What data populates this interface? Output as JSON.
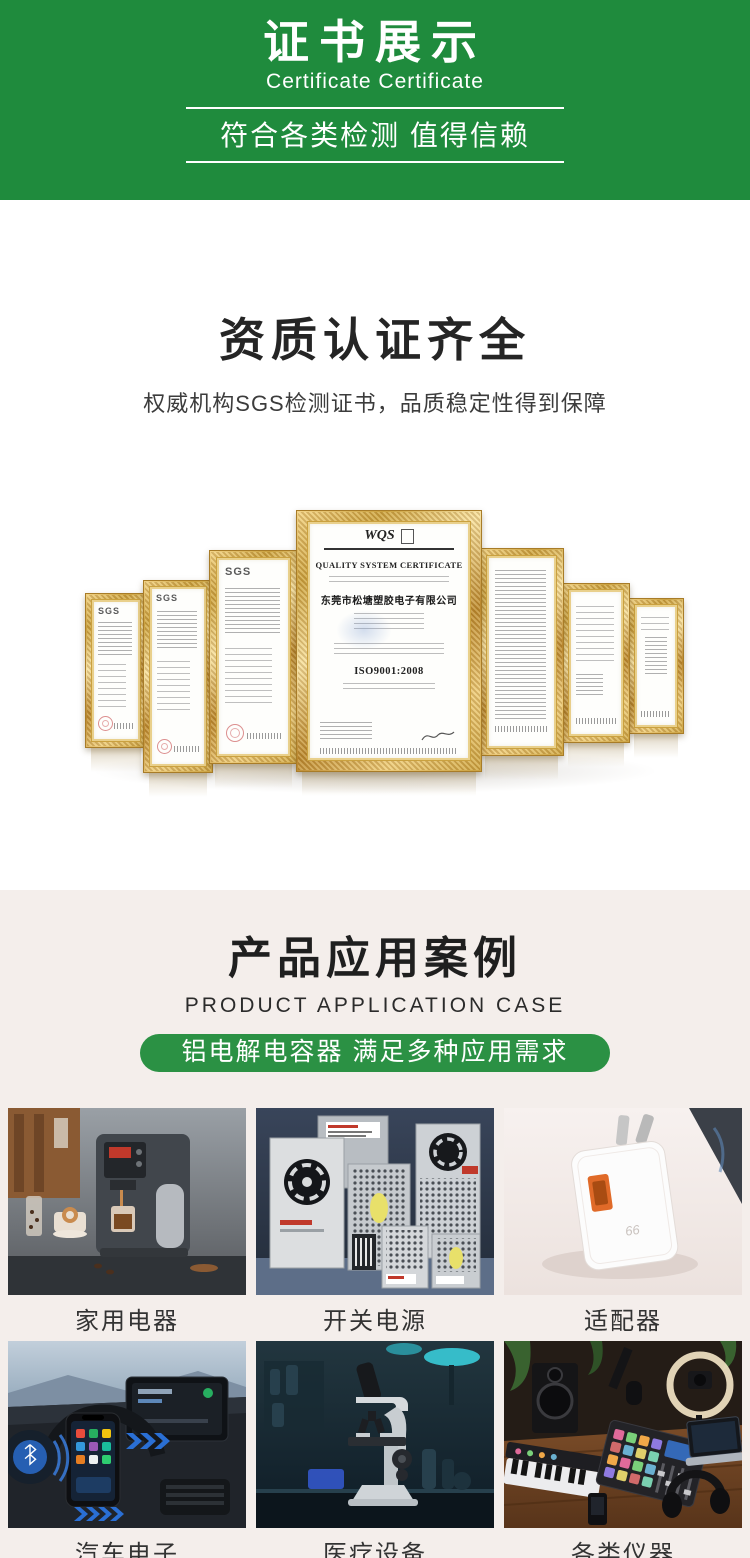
{
  "banner": {
    "title": "证书展示",
    "subtitle": "Certificate Certificate",
    "tagline": "符合各类检测 值得信赖",
    "bg_color": "#1f8b3d"
  },
  "qualification": {
    "heading": "资质认证齐全",
    "description": "权威机构SGS检测证书，品质稳定性得到保障",
    "certificates": {
      "sgs_label": "SGS",
      "center": {
        "logo": "WQS",
        "title": "QUALITY SYSTEM CERTIFICATE",
        "company": "东莞市松塘塑胶电子有限公司",
        "standard": "ISO9001:2008"
      }
    }
  },
  "applications": {
    "heading": "产品应用案例",
    "subheading": "PRODUCT APPLICATION CASE",
    "badge": "铝电解电容器 满足多种应用需求",
    "badge_color": "#2b9144",
    "items": [
      {
        "label": "家用电器",
        "icon": "coffee-machine"
      },
      {
        "label": "开关电源",
        "icon": "switching-power-supply"
      },
      {
        "label": "适配器",
        "icon": "usb-charger"
      },
      {
        "label": "汽车电子",
        "icon": "car-dashboard"
      },
      {
        "label": "医疗设备",
        "icon": "microscope"
      },
      {
        "label": "各类仪器",
        "icon": "audio-equipment"
      }
    ]
  },
  "colors": {
    "banner_green": "#1f8b3d",
    "badge_green": "#2b9144",
    "apps_background": "#f4eeeb",
    "frame_gold": "#d9a33c"
  }
}
